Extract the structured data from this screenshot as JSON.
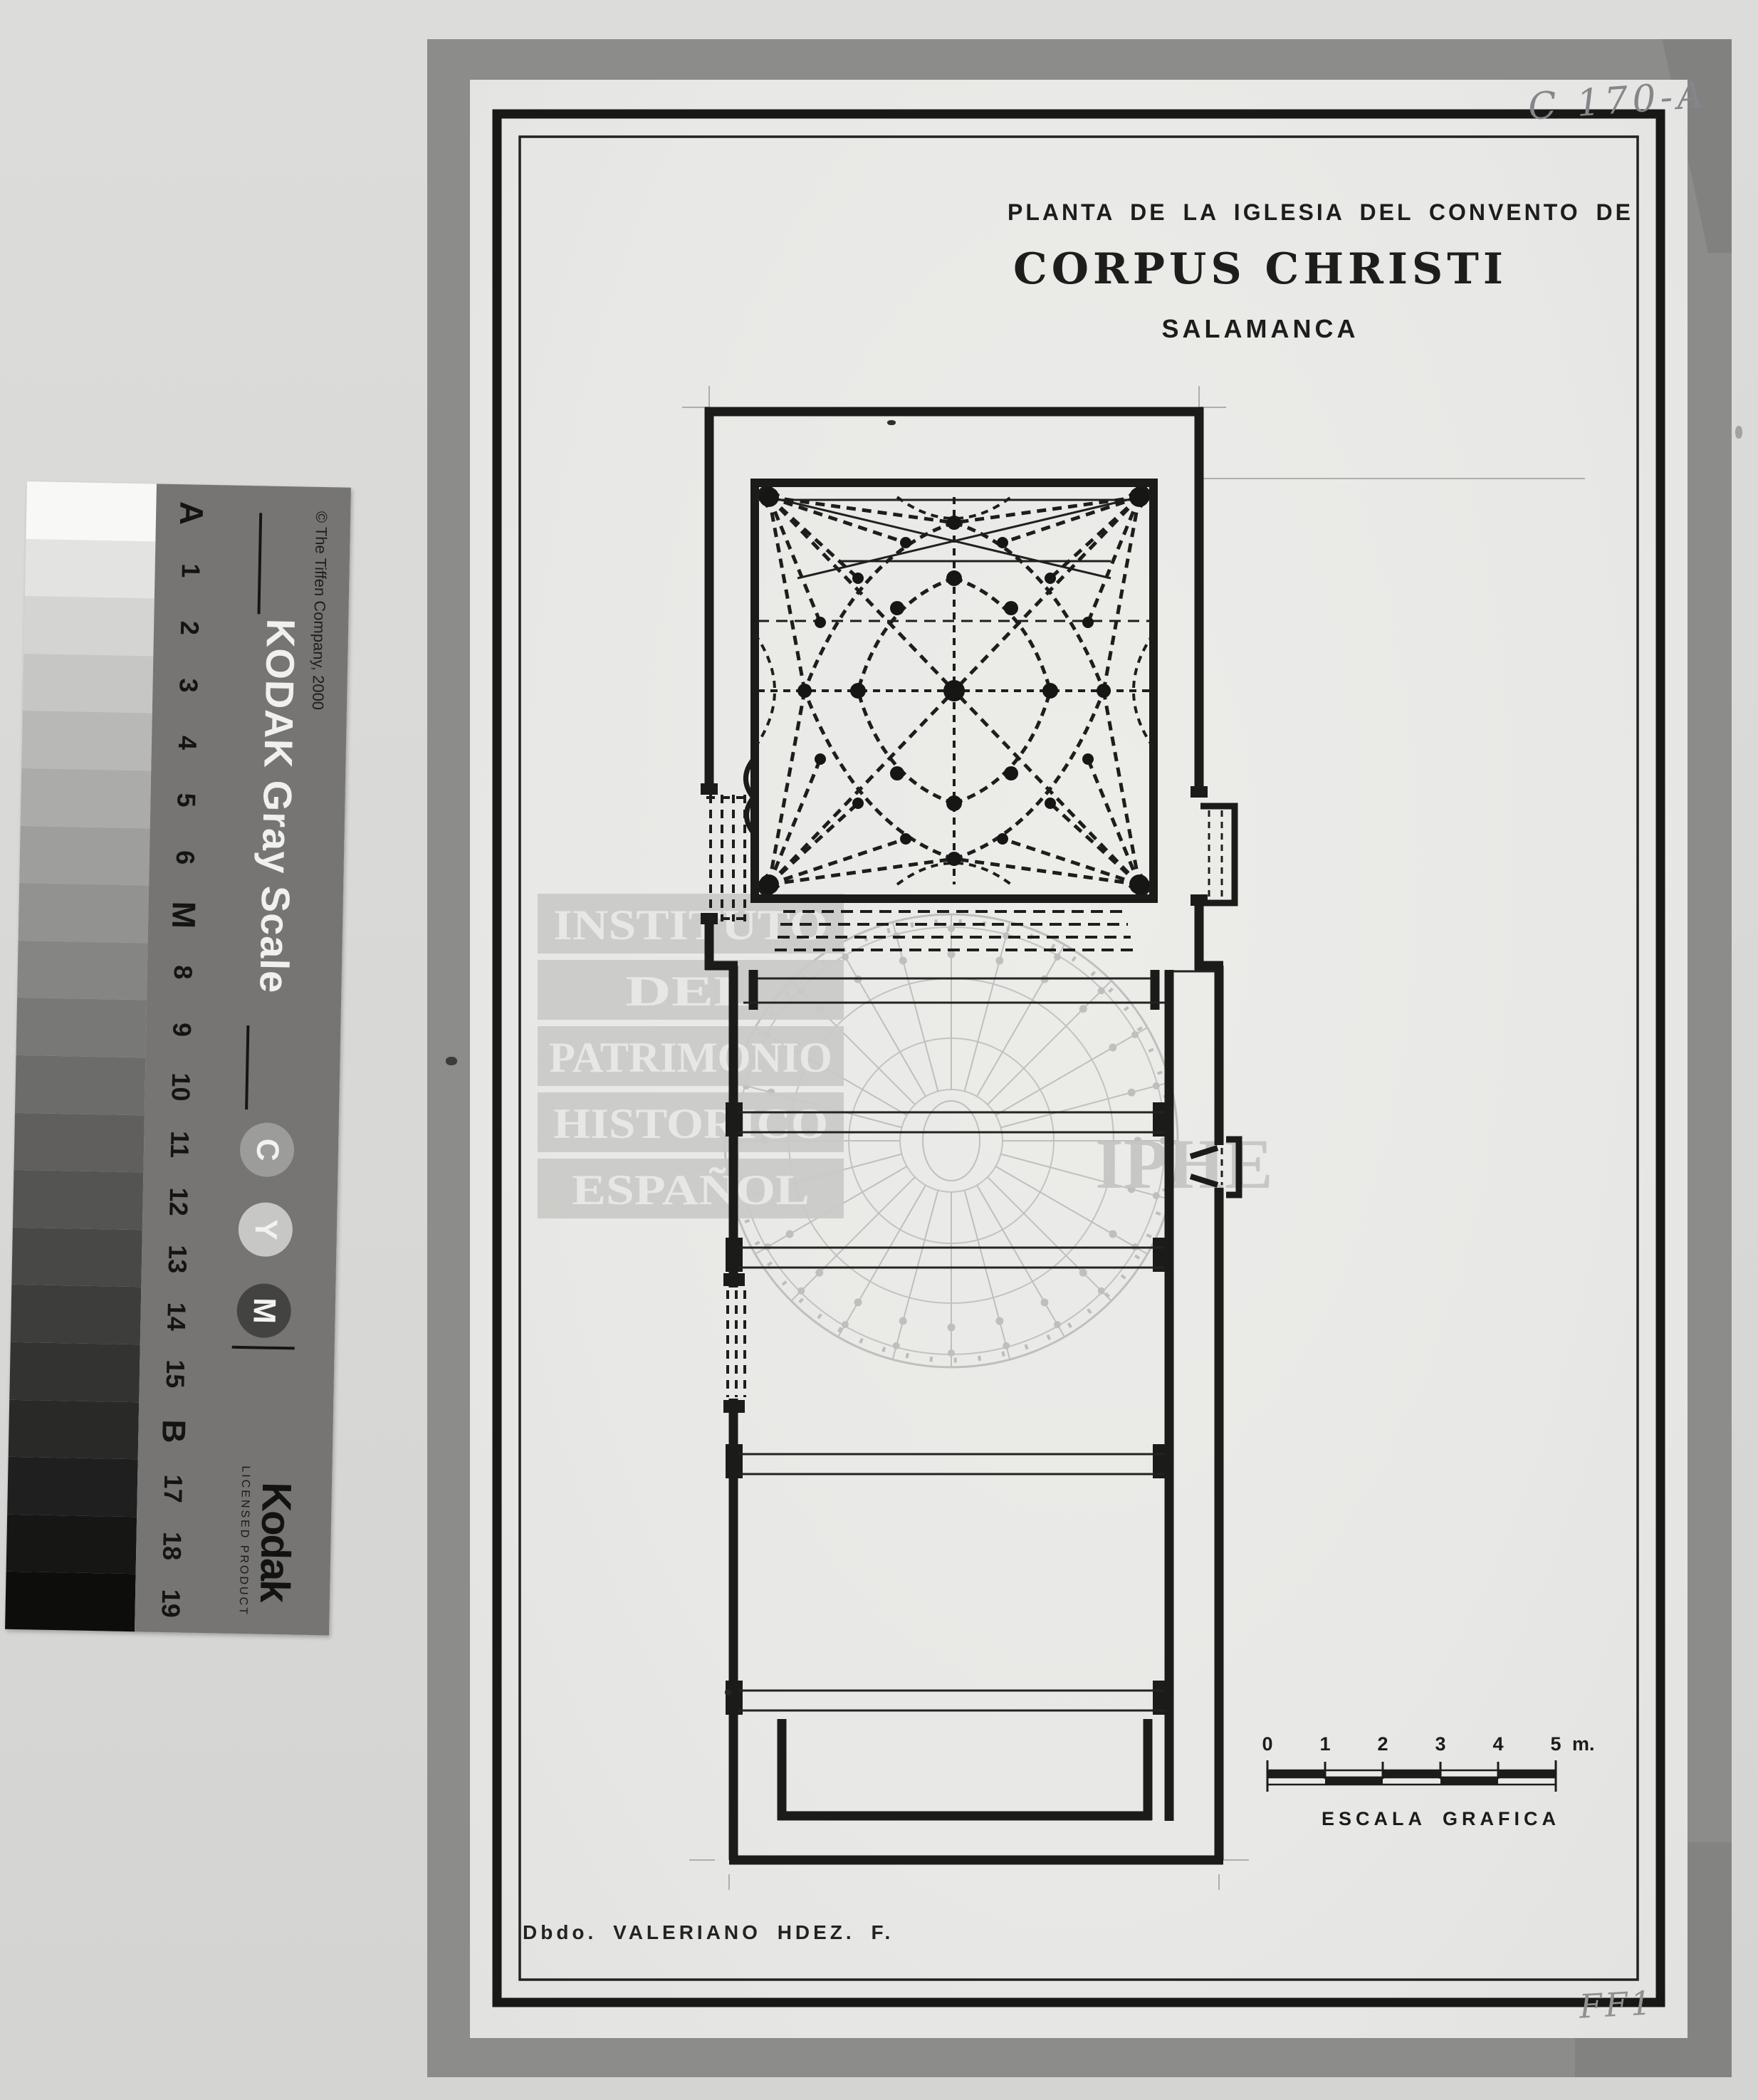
{
  "annotations": {
    "catalog_number": "C 170-A",
    "bottom_right_mark": "FF1"
  },
  "kodak_strip": {
    "title": "KODAK Gray Scale",
    "copyright": "© The Tiffen Company, 2000",
    "logo": "Kodak",
    "licensed": "LICENSED PRODUCT",
    "circles": [
      "C",
      "Y",
      "M"
    ],
    "steps": [
      "A",
      "1",
      "2",
      "3",
      "4",
      "5",
      "6",
      "M",
      "8",
      "9",
      "10",
      "11",
      "12",
      "13",
      "14",
      "15",
      "B",
      "17",
      "18",
      "19"
    ],
    "patch_colors": [
      "#f8f8f6",
      "#e3e3e1",
      "#d4d4d2",
      "#c6c6c4",
      "#b8b8b6",
      "#ababa9",
      "#9e9e9c",
      "#929290",
      "#858583",
      "#787876",
      "#6c6c6a",
      "#605f5e",
      "#545453",
      "#484847",
      "#3d3d3c",
      "#333332",
      "#292928",
      "#201f1f",
      "#161615",
      "#0d0d0c"
    ]
  },
  "drawing": {
    "title_line1": "PLANTA DE LA IGLESIA DEL CONVENTO DE",
    "title_line2": "CORPUS CHRISTI",
    "title_line3": "SALAMANCA",
    "signature": "Dbdo. VALERIANO HDEZ. F.",
    "scale_bar": {
      "ticks": [
        "0",
        "1",
        "2",
        "3",
        "4",
        "5"
      ],
      "unit": "m.",
      "caption_word1": "ESCALA",
      "caption_word2": "GRAFICA"
    }
  },
  "watermark": {
    "lines": [
      "INSTITUTO",
      "DEL",
      "PATRIMONIO",
      "HISTORICO",
      "ESPAÑOL"
    ],
    "acronym": "IPHE"
  }
}
